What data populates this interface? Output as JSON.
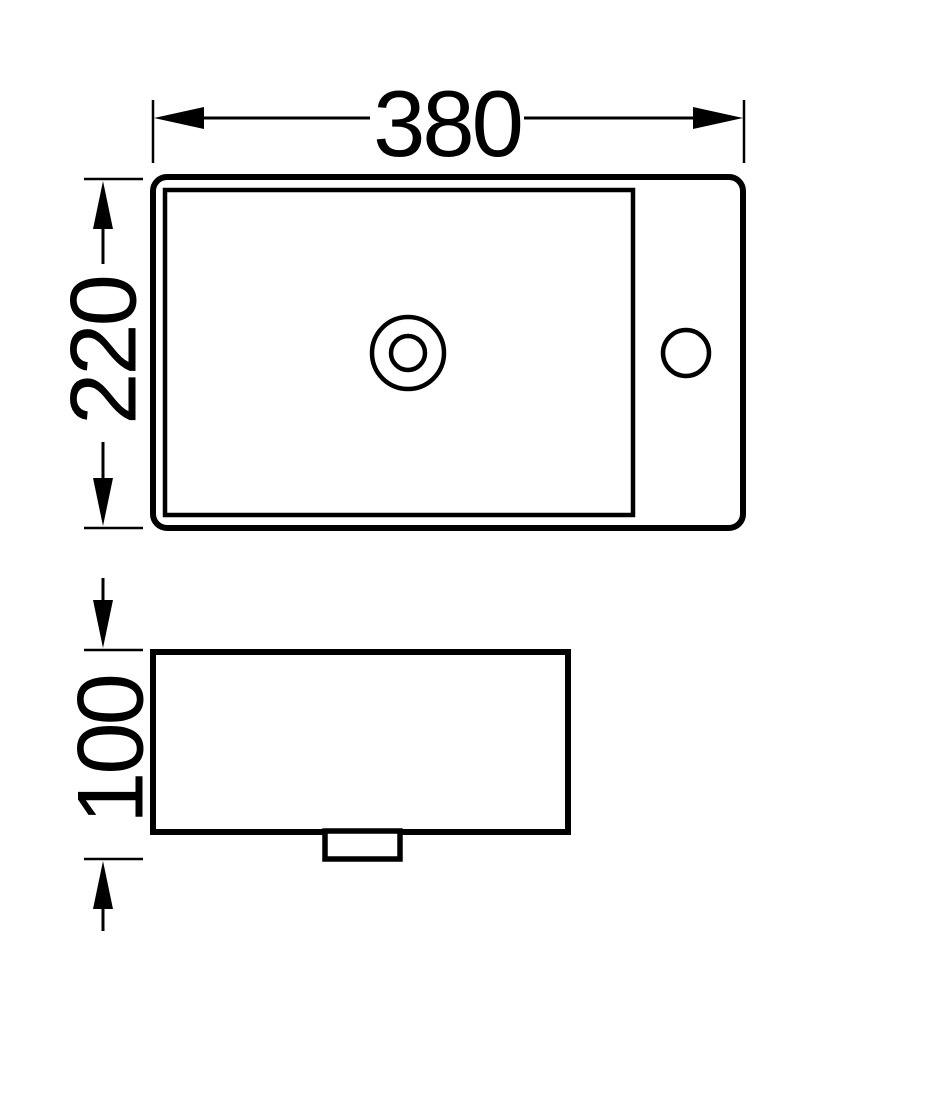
{
  "drawing": {
    "background_color": "#ffffff",
    "line_color": "#000000",
    "dimensions": {
      "width": {
        "label": "380"
      },
      "depth": {
        "label": "220"
      },
      "height": {
        "label": "100"
      }
    }
  }
}
